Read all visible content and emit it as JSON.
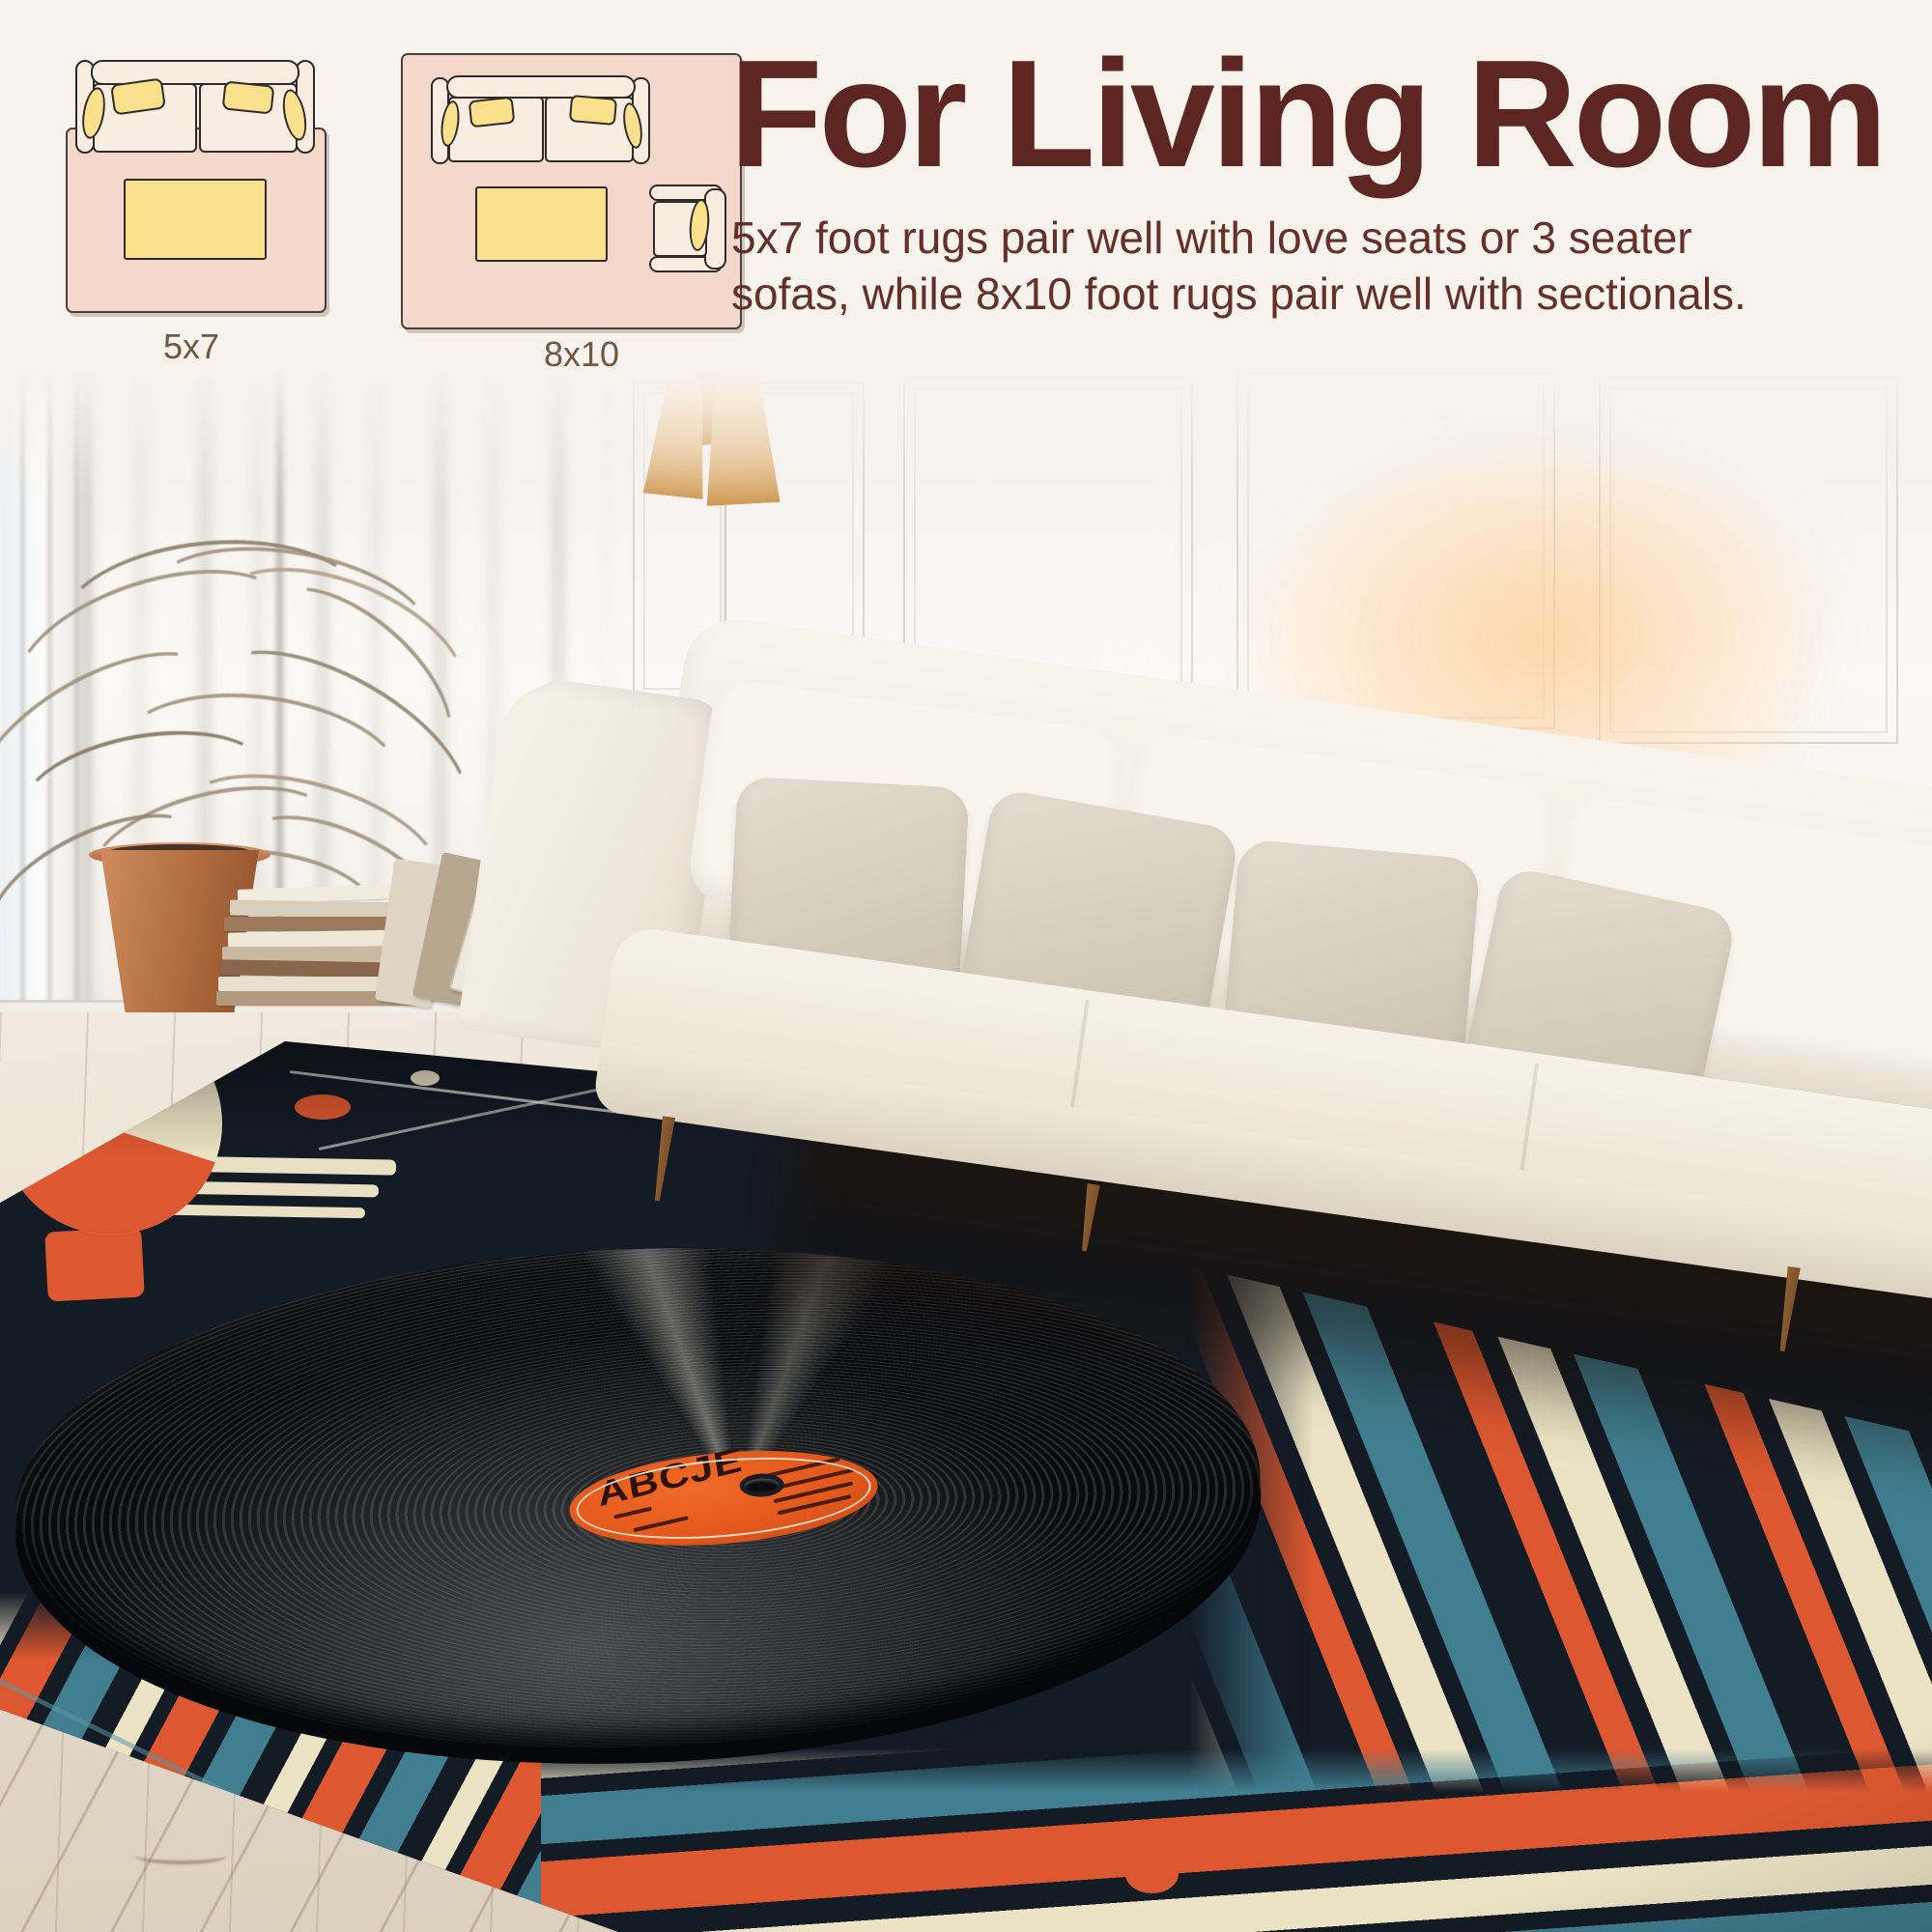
{
  "headline": "For Living Room",
  "body": {
    "line1": "5x7 foot rugs pair well with love seats or 3 seater",
    "line2": "sofas, while 8x10 foot rugs pair well with sectionals."
  },
  "size_guide": {
    "small": {
      "label": "5x7"
    },
    "large": {
      "label": "8x10"
    }
  },
  "record": {
    "brand": "ABCJE"
  },
  "colors": {
    "banner_background": "#f8f2ec",
    "heading_text": "#5d2621",
    "body_text": "#643029",
    "diagram_label_text": "#6f5741",
    "diagram_rug_pink": "#f3d8ca",
    "cushion_yellow": "#f8e08d",
    "rug_base": "#131b25",
    "rug_orange": "#dd5830",
    "rug_teal": "#417e90",
    "rug_cream": "#ece3c5",
    "record_label_orange": "#e2571c"
  }
}
